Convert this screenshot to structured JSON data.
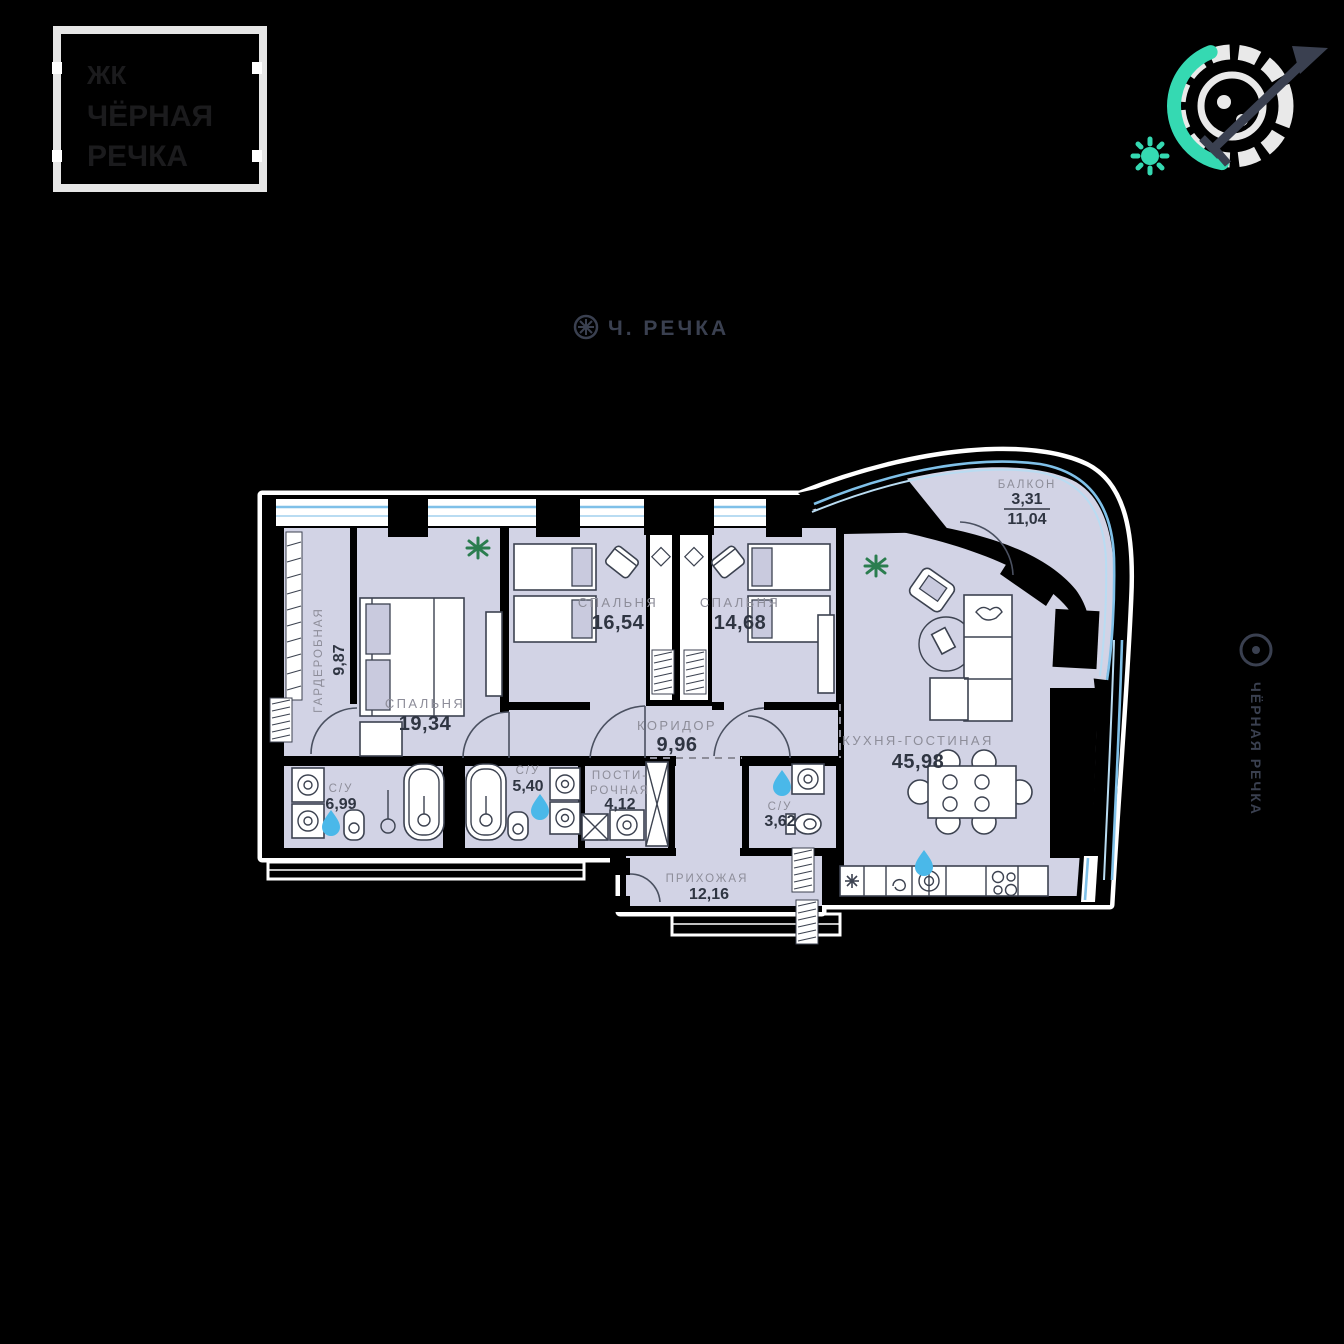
{
  "logo": {
    "line1": "ЖК",
    "line2": "ЧЁРНАЯ",
    "line3": "РЕЧКА"
  },
  "header": {
    "title": "Ч. РЕЧКА"
  },
  "side_label": {
    "text": "ЧЁРНАЯ РЕЧКА"
  },
  "plan": {
    "rooms": [
      {
        "id": "wardrobe",
        "label": "ГАРДЕРОБНАЯ",
        "area": "9,87"
      },
      {
        "id": "bedroom-master",
        "label": "СПАЛЬНЯ",
        "area": "19,34"
      },
      {
        "id": "bedroom-2",
        "label": "СПАЛЬНЯ",
        "area": "16,54"
      },
      {
        "id": "bedroom-3",
        "label": "СПАЛЬНЯ",
        "area": "14,68"
      },
      {
        "id": "corridor",
        "label": "КОРИДОР",
        "area": "9,96"
      },
      {
        "id": "kitchen-living",
        "label": "КУХНЯ-ГОСТИНАЯ",
        "area": "45,98"
      },
      {
        "id": "bath-1",
        "label": "С/У",
        "area": "6,99"
      },
      {
        "id": "bath-2",
        "label": "С/У",
        "area": "5,40"
      },
      {
        "id": "laundry",
        "label_line1": "ПОСТИ-",
        "label_line2": "РОЧНАЯ",
        "area": "4,12"
      },
      {
        "id": "bath-3",
        "label": "С/У",
        "area": "3,62"
      },
      {
        "id": "hallway",
        "label": "ПРИХОЖАЯ",
        "area": "12,16"
      },
      {
        "id": "balcony",
        "label": "БАЛКОН",
        "area_reduced": "3,31",
        "area_full": "11,04"
      }
    ]
  },
  "colors": {
    "background": "#000000",
    "room_fill": "#d2d3e5",
    "wall": "#000000",
    "wall_outline": "#ffffff",
    "window_blue": "#7fc0e8",
    "window_blue_light": "#b9dcf2",
    "accent_teal": "#35d9b2",
    "furniture_line": "#3c4250",
    "label_gray": "#8d8d99",
    "value_dark": "#2f3542",
    "drop_blue": "#4ab8e9",
    "plant_green": "#2b7d4f",
    "logo_border": "#e6e6e6",
    "logo_text": "#1b1b1d",
    "title_text": "#3a4050"
  }
}
